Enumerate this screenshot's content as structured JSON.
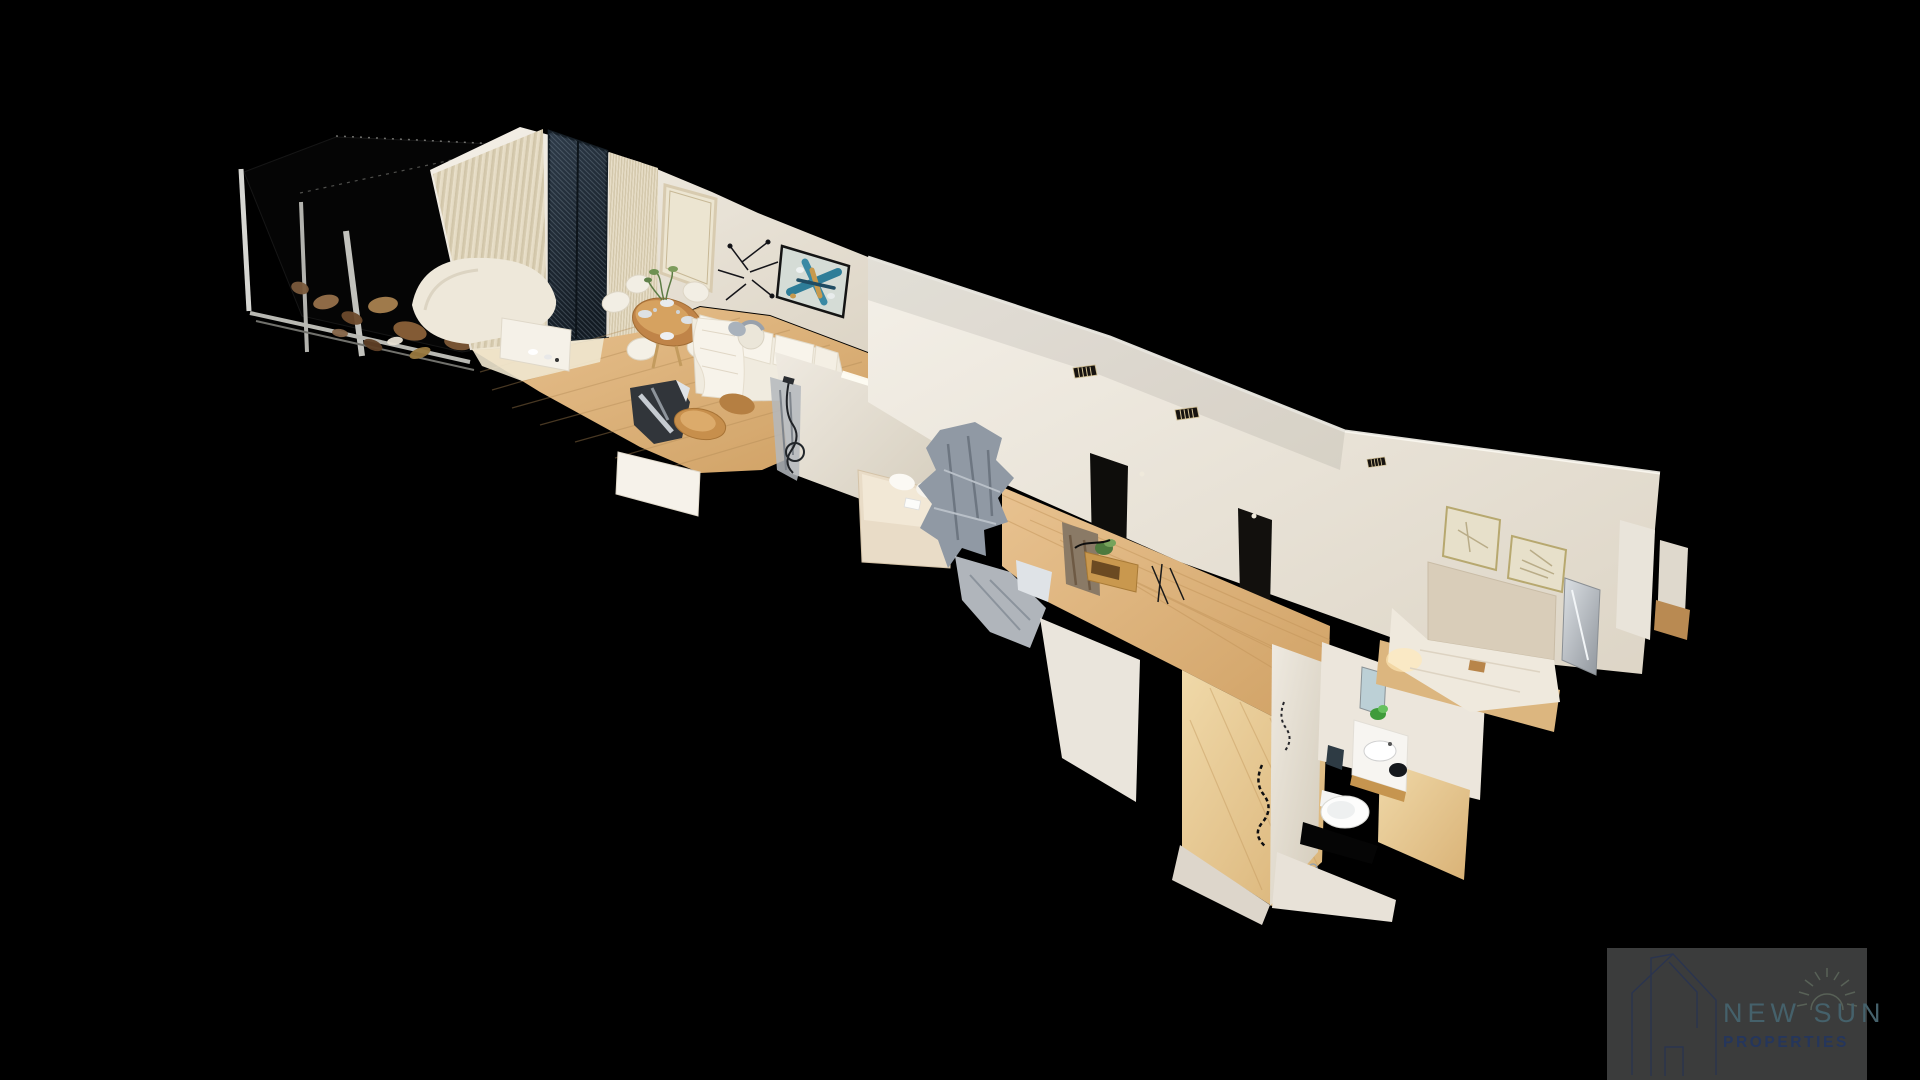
{
  "watermark": {
    "brand_name": "NEW SUN",
    "brand_subtitle": "PROPERTIES",
    "logo_icon": "house-outline-icon",
    "sun_icon": "sun-rays-icon",
    "background_color": "#3b3c3c",
    "brand_name_color": "#45616b",
    "brand_subtitle_color": "#25365c",
    "logo_line_color": "#2a3450",
    "sun_color": "#5c665a"
  },
  "viewport": {
    "background_color": "#000000",
    "view_mode": "dollhouse-3d",
    "regions": [
      "terrace",
      "living-room",
      "dining-area",
      "hallway",
      "bedroom",
      "master-bedroom",
      "bathroom"
    ]
  },
  "palette": {
    "wall": "#eae5dc",
    "wall_shadow": "#d8d1c3",
    "floor_wood": "#dcb67f",
    "floor_wood_light": "#e9cf9e",
    "window_glass": "#27323c",
    "artwork_blue": "#2e7d98",
    "artwork_gold": "#c89a4e"
  }
}
